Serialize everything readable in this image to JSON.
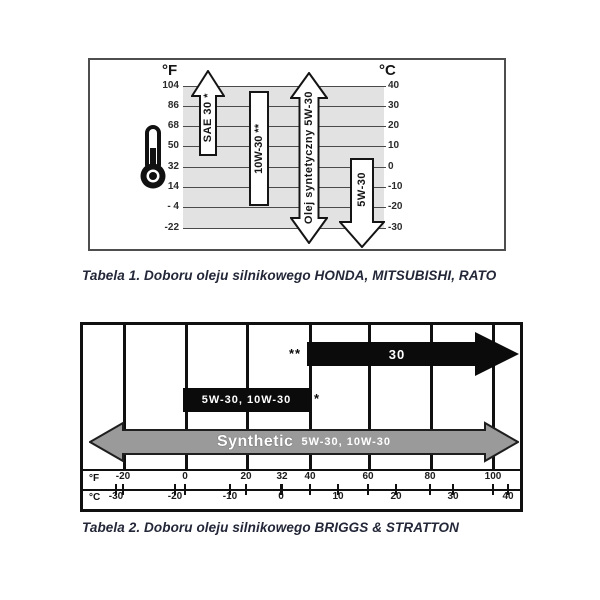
{
  "figure1": {
    "caption": "Tabela 1. Doboru oleju silnikowego HONDA, MITSUBISHI, RATO",
    "f_axis_label": "°F",
    "c_axis_label": "°C",
    "f_ticks": [
      "104",
      "86",
      "68",
      "50",
      "32",
      "14",
      "- 4",
      "-22"
    ],
    "c_ticks": [
      "40",
      "30",
      "20",
      "10",
      "0",
      "-10",
      "-20",
      "-30"
    ],
    "bar_sae30": "SAE 30 *",
    "bar_10w30": "10W-30 **",
    "bar_synthetic": "Olej syntetyczny 5W-30",
    "bar_5w30": "5W-30"
  },
  "figure2": {
    "caption": "Tabela 2. Doboru oleju silnikowego BRIGGS & STRATTON",
    "f_axis_label": "°F",
    "c_axis_label": "°C",
    "f_ticks": [
      "-20",
      "0",
      "20",
      "32",
      "40",
      "60",
      "80",
      "100"
    ],
    "c_ticks": [
      "-30",
      "-20",
      "-10",
      "0",
      "10",
      "20",
      "30",
      "40"
    ],
    "arrow_30": "30",
    "arrow_30_note": "**",
    "bar_5w30_10w30": "5W-30, 10W-30",
    "bar_5w30_10w30_note": "*",
    "synthetic_big": "Synthetic",
    "synthetic_small": "5W-30, 10W-30"
  },
  "colors": {
    "band_gray": "#e2e2e2",
    "black_fill": "#0b0b0b",
    "gray_arrow_fill": "#9a9a9a",
    "caption_text": "#232738"
  },
  "chart_data": [
    {
      "type": "range-bars-vertical",
      "title": "Tabela 1. Doboru oleju silnikowego HONDA, MITSUBISHI, RATO",
      "axis_f_ticks": [
        104,
        86,
        68,
        50,
        32,
        14,
        -4,
        -22
      ],
      "axis_c_ticks": [
        40,
        30,
        20,
        10,
        0,
        -10,
        -20,
        -30
      ],
      "axis_range_c": [
        -30,
        40
      ],
      "grid": true,
      "series": [
        {
          "name": "SAE 30 *",
          "from_c": 5,
          "to_c": 40,
          "shape": "arrow-up",
          "fill": "white"
        },
        {
          "name": "10W-30 **",
          "from_c": -20,
          "to_c": 38,
          "shape": "bar",
          "fill": "white"
        },
        {
          "name": "Olej syntetyczny 5W-30",
          "from_c": -30,
          "to_c": 40,
          "shape": "arrow-both",
          "fill": "white"
        },
        {
          "name": "5W-30",
          "from_c": -30,
          "to_c": 4,
          "shape": "arrow-down",
          "fill": "white"
        }
      ]
    },
    {
      "type": "range-bars-horizontal",
      "title": "Tabela 2. Doboru oleju silnikowego BRIGGS & STRATTON",
      "axis_f_ticks": [
        -20,
        0,
        20,
        32,
        40,
        60,
        80,
        100
      ],
      "axis_c_ticks": [
        -30,
        -20,
        -10,
        0,
        10,
        20,
        30,
        40
      ],
      "axis_range_f": [
        -31,
        108
      ],
      "grid": true,
      "series": [
        {
          "name": "30",
          "note": "**",
          "from_f": 40,
          "to_f": 108,
          "shape": "arrow-right",
          "fill": "black"
        },
        {
          "name": "5W-30, 10W-30",
          "note": "*",
          "from_f": 0,
          "to_f": 40,
          "shape": "bar",
          "fill": "black"
        },
        {
          "name": "Synthetic 5W-30, 10W-30",
          "from_f": -31,
          "to_f": 108,
          "shape": "arrow-both",
          "fill": "gray"
        }
      ]
    }
  ]
}
